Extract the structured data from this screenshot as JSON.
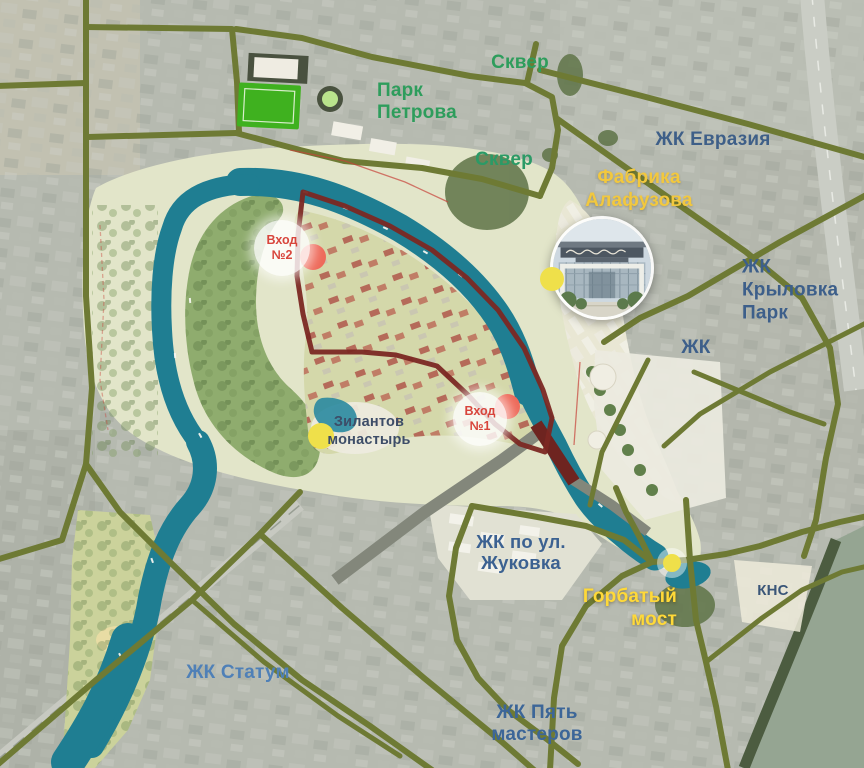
{
  "labels": {
    "skver_north": {
      "text": "Сквер",
      "color": "#2E9D5C"
    },
    "park_petrova": {
      "text": "Парк\nПетрова",
      "color": "#2E9D5C"
    },
    "skver_south": {
      "text": "Сквер",
      "color": "#2B9A66"
    },
    "zk_evraziya": {
      "text": "ЖК Евразия",
      "color": "#3E5F88"
    },
    "fabrika_alafuzova": {
      "text": "Фабрика\nАлафузова",
      "color": "#F2C83E"
    },
    "zk_krylovka_park": {
      "text": "ЖК\nКрыловка\nПарк",
      "color": "#3D5F8A"
    },
    "zk": {
      "text": "ЖК",
      "color": "#3D5F8A"
    },
    "zilantov_monastery": {
      "text": "Зилантов\nмонастырь",
      "color": "#3D4D68"
    },
    "zk_zhukovka": {
      "text": "ЖК по ул.\nЖуковка",
      "color": "#3B6191"
    },
    "gorbaty_most": {
      "text": "Горбатый\nмост",
      "color": "#FFD938"
    },
    "kns": {
      "text": "КНС",
      "color": "#3A5678"
    },
    "zk_statum": {
      "text": "ЖК Статум",
      "color": "#4F80B7"
    },
    "zk_pyat_masterov": {
      "text": "ЖК Пять\nмастеров",
      "color": "#3C6698"
    },
    "vhod1": {
      "text": "Вход\n№1",
      "color": "#D8453C"
    },
    "vhod2": {
      "text": "Вход\n№2",
      "color": "#D8453C"
    }
  },
  "map_palette": {
    "road": "#6E7A34",
    "river": "#1F7E92",
    "boundary": "#7B2823",
    "big_water": "#95A592",
    "park_base": "#E2E5C9",
    "park_green": "#8FAC6E",
    "settlement": "#D4D8AA",
    "red_dot": "#EE6A5A",
    "yellow_dot": "#EFE04A",
    "green_dot": "#B9E38C",
    "entrance_circle": "rgba(255,255,255,0.82)"
  }
}
